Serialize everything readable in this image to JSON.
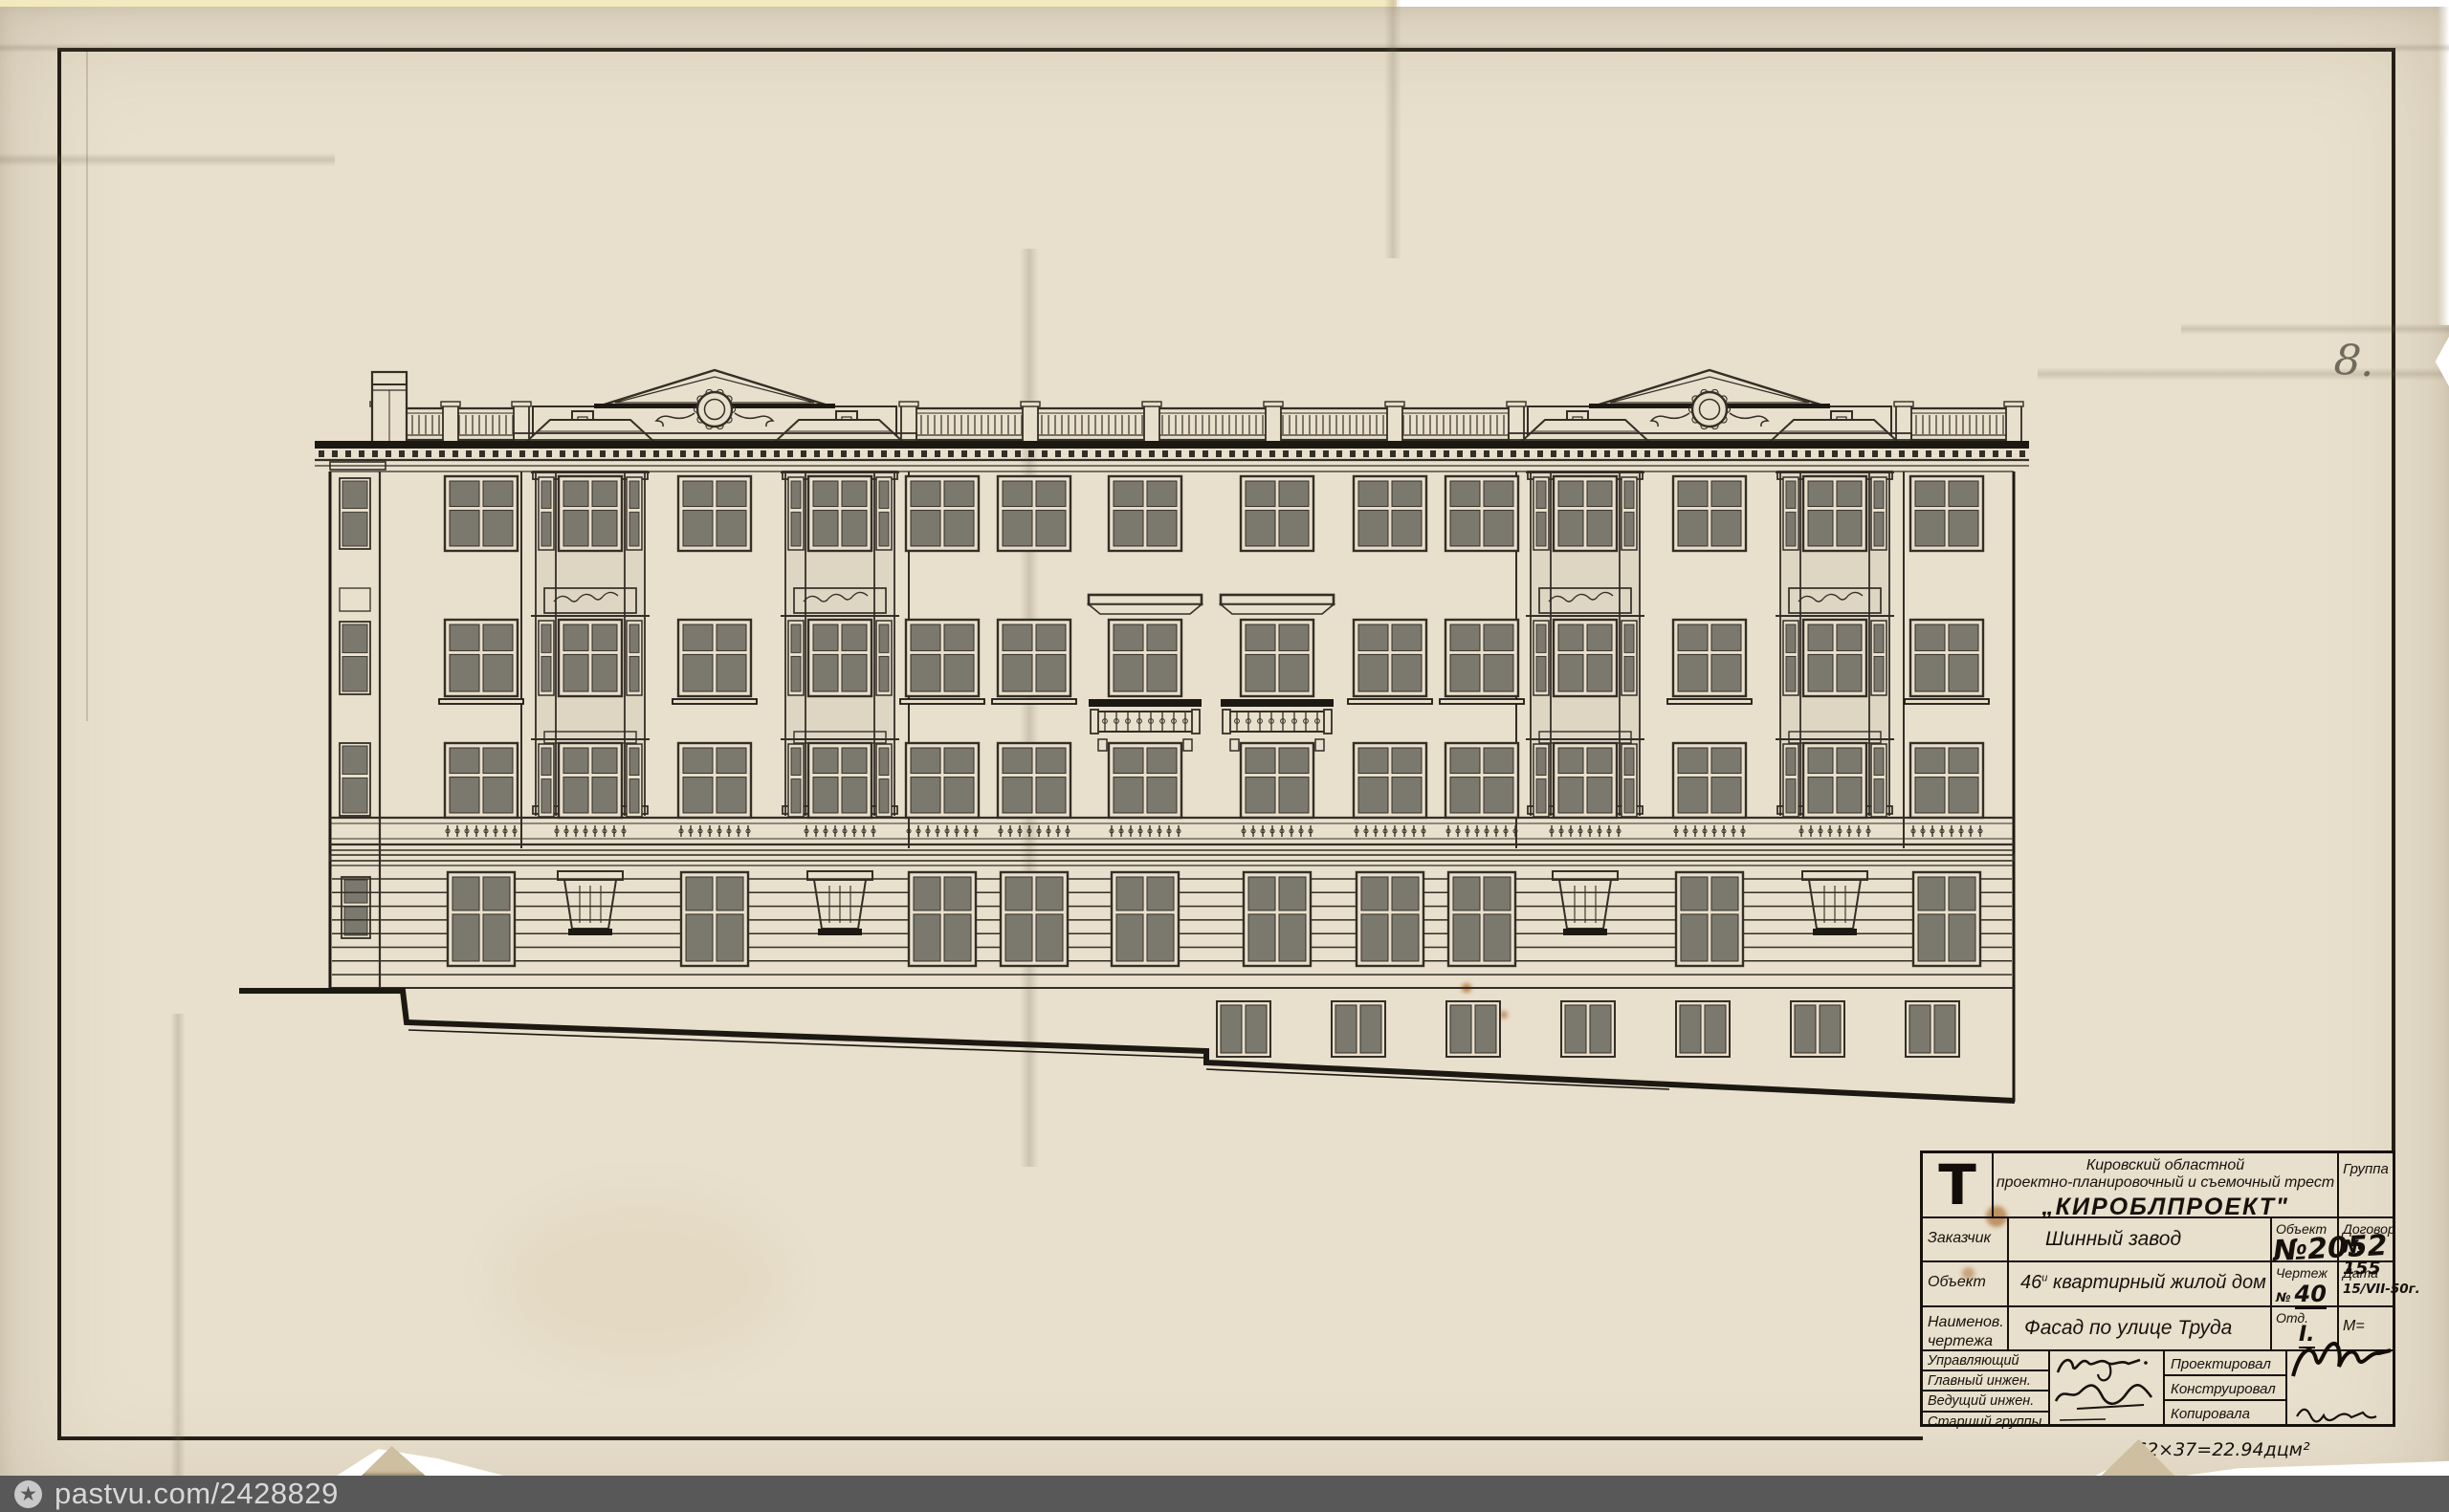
{
  "colors": {
    "background": "#ffffff",
    "paper": "#e8dfcc",
    "paper_edge": "#d8cfba",
    "top_sliver": "#f2e9bf",
    "ink": "#332e26",
    "ink_heavy": "#1c1812",
    "glass": "#7b786e",
    "pencil": "#7c7567",
    "stain": "#a96a2c",
    "watermark_bar": "#585858",
    "watermark_text": "#d8d8d8"
  },
  "sheet": {
    "number_note": "8."
  },
  "watermark": {
    "icon_glyph": "★",
    "url_text": "pastvu.com/2428829"
  },
  "title_block": {
    "logo_letter": "Т",
    "org_line1": "Кировский областной",
    "org_line2": "проектно-планировочный и съемочный трест",
    "trust_name": "„КИРОБЛПРОЕКТ\"",
    "group_label": "Группа",
    "customer": {
      "label": "Заказчик",
      "value": "Шинный завод"
    },
    "object_no": {
      "label": "Объект",
      "no": "№",
      "value": "2052"
    },
    "contract": {
      "label": "Договор",
      "no": "№",
      "value": "155"
    },
    "object": {
      "label": "Объект",
      "num": "46",
      "sup": "и",
      "rest": "квартирный жилой дом"
    },
    "drawing_no": {
      "label": "Чертеж",
      "no": "№",
      "value": "40"
    },
    "date": {
      "label": "Дата",
      "value": "15/VII-50г."
    },
    "drawing_name": {
      "label1": "Наименов.",
      "label2": "чертежа",
      "value": "Фасад по улице Труда"
    },
    "dept": {
      "label": "Отд.",
      "value": "I."
    },
    "scale": {
      "label": "М="
    },
    "sign_left": [
      "Управляющий",
      "Главный инжен.",
      "Ведущий инжен.",
      "Старший группы"
    ],
    "sign_right": [
      "Проектировал",
      "Конструировал",
      "Копировала"
    ],
    "area_note": "62×37=22.94дцм²"
  }
}
